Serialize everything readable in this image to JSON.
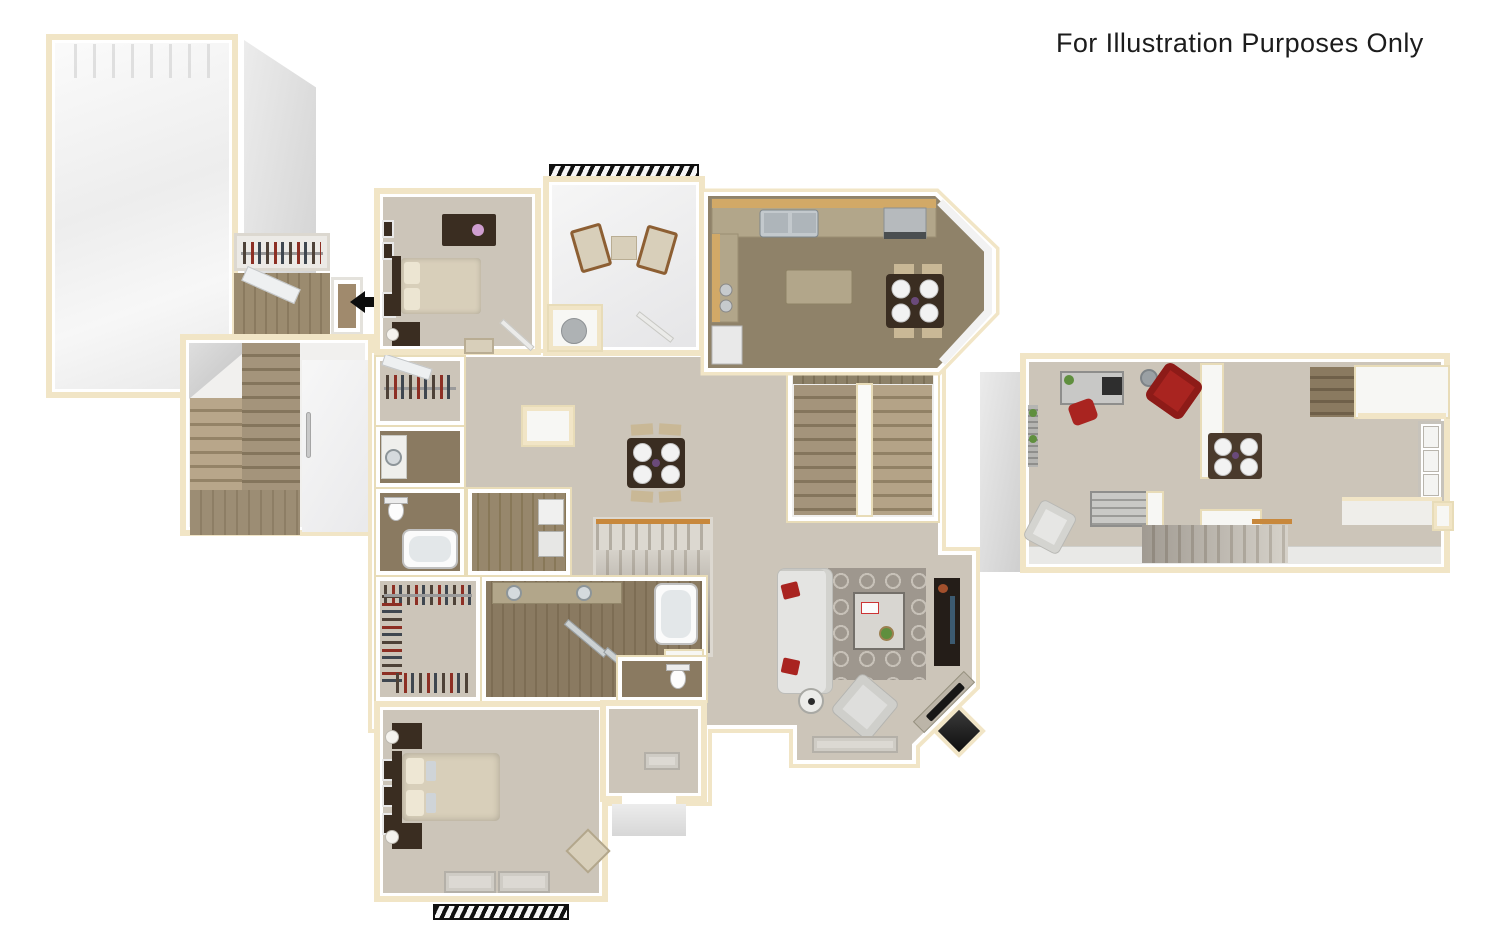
{
  "annotation": {
    "title": "For Illustration Purposes Only"
  },
  "palette": {
    "wall-tan": "#f1e5c6",
    "wall-tanline": "#e8dcb8",
    "carpet": "#ccc5b9",
    "carpet-light": "#d4cec3",
    "wood": "#8f8269",
    "tile": "#8a7a61",
    "granite": "#b2a68a",
    "counter-wood": "#d2a967",
    "stair-light": "#a4947b",
    "stair-dark": "#84755c",
    "furn-dark": "#3a2d21",
    "bed-beige": "#d8cfba",
    "accent-red": "#a92420",
    "rug": "#9e978e",
    "steel": "#bdc2c6",
    "rail-orange": "#c8883c",
    "arrow-black": "#0d0d0d",
    "text": "#1c1c1c"
  }
}
